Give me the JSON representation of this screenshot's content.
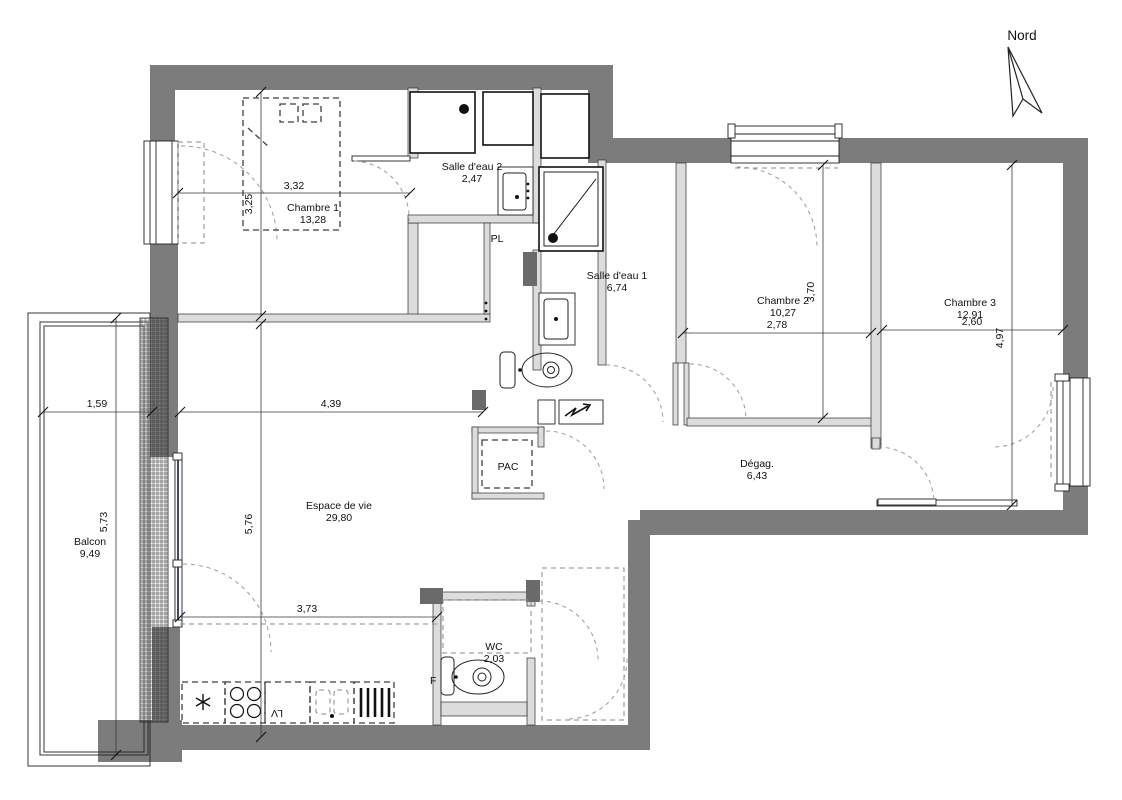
{
  "compass": {
    "label": "Nord"
  },
  "rooms": {
    "chambre1": {
      "name": "Chambre 1",
      "area": "13,28"
    },
    "salle_eau_2": {
      "name": "Salle d'eau 2",
      "area": "2,47"
    },
    "salle_eau_1": {
      "name": "Salle d'eau 1",
      "area": "6,74"
    },
    "chambre2": {
      "name": "Chambre 2",
      "area": "10,27"
    },
    "chambre3": {
      "name": "Chambre 3",
      "area": "12,91"
    },
    "espace_de_vie": {
      "name": "Espace de vie",
      "area": "29,80"
    },
    "degagement": {
      "name": "Dégag.",
      "area": "6,43"
    },
    "wc": {
      "name": "WC",
      "area": "2,03"
    },
    "balcon": {
      "name": "Balcon",
      "area": "9,49"
    }
  },
  "closets": {
    "pl": "PL",
    "pac": "PAC"
  },
  "appliances": {
    "oven": "F",
    "dishwasher": "LV"
  },
  "dimensions": {
    "chambre1_width": "3,32",
    "chambre1_depth": "3,25",
    "chambre2_width": "2,78",
    "chambre2_depth": "3,70",
    "chambre3_width": "2,60",
    "chambre3_depth": "4,97",
    "balcon_width": "1,59",
    "balcon_depth": "5,73",
    "living_width": "4,39",
    "living_depth": "5,76",
    "kitchen_width": "3,73"
  },
  "colors": {
    "wall": "#7c7c7c",
    "partition": "#dcdcdc",
    "glazing": "#3c4a6e"
  }
}
